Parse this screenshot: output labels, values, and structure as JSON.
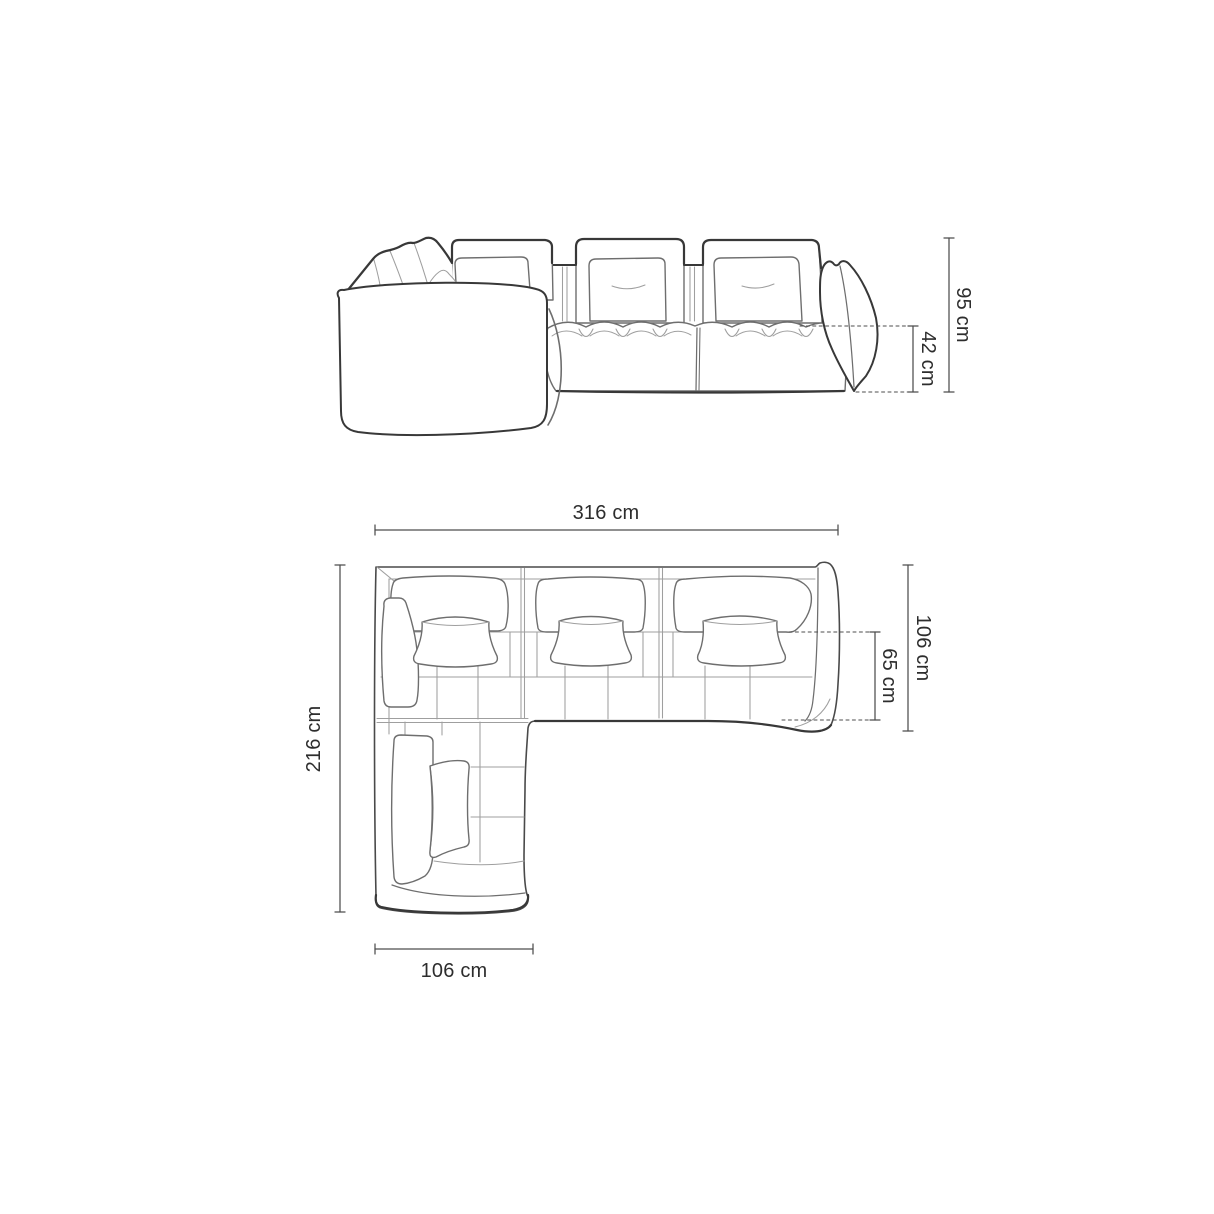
{
  "diagram": {
    "front_view": {
      "dimensions": [
        {
          "name": "overall-height",
          "label": "95 cm",
          "value_cm": 95,
          "orientation": "vertical"
        },
        {
          "name": "seat-height",
          "label": "42 cm",
          "value_cm": 42,
          "orientation": "vertical"
        }
      ]
    },
    "top_view": {
      "dimensions": [
        {
          "name": "overall-width",
          "label": "316 cm",
          "value_cm": 316,
          "orientation": "horizontal"
        },
        {
          "name": "overall-depth",
          "label": "216 cm",
          "value_cm": 216,
          "orientation": "vertical"
        },
        {
          "name": "side-depth",
          "label": "106 cm",
          "value_cm": 106,
          "orientation": "vertical"
        },
        {
          "name": "seat-depth",
          "label": "65 cm",
          "value_cm": 65,
          "orientation": "vertical"
        },
        {
          "name": "chaise-width",
          "label": "106 cm",
          "value_cm": 106,
          "orientation": "horizontal"
        }
      ]
    },
    "style": {
      "background": "#ffffff",
      "line_dark": "#383838",
      "line_medium": "#6e6e6e",
      "line_light": "#9f9f9f",
      "dimension_line": "#4d4d4d",
      "label_color": "#2d2d2d"
    }
  }
}
